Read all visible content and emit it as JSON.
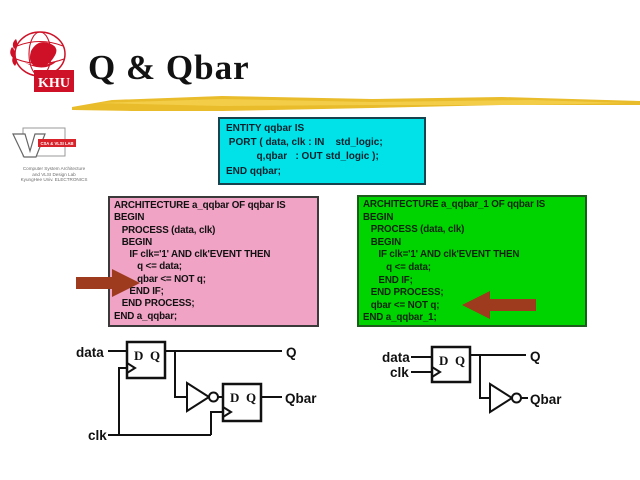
{
  "colors": {
    "entity_bg": "#00E2E8",
    "arch_left_bg": "#F1A3C5",
    "arch_right_bg": "#00D400",
    "arrow": "#9E3A1E",
    "underline_gold": "#E9BC2B",
    "underline_gold_light": "#F4D04E",
    "logo_red": "#CE1126"
  },
  "header": {
    "title": "Q & Qbar",
    "khu_logo_text": "KHU"
  },
  "lab_logo": {
    "banner_text": "CSA & VLSI LAB",
    "caption_lines": [
      "Computer System Architecture",
      "and VLSI Design Lab",
      "KyungHee Univ. ELECTRONICS"
    ]
  },
  "entity_box": {
    "lines": [
      "ENTITY qqbar IS",
      " PORT ( data, clk : IN    std_logic;",
      "           q,qbar   : OUT std_logic );",
      "END qqbar;"
    ]
  },
  "arch_left_box": {
    "lines": [
      "ARCHITECTURE a_qqbar OF qqbar IS",
      "BEGIN",
      "   PROCESS (data, clk)",
      "   BEGIN",
      "      IF clk='1' AND clk'EVENT THEN",
      "         q <= data;",
      "         qbar <= NOT q;",
      "      END IF;",
      "   END PROCESS;",
      "END a_qqbar;"
    ]
  },
  "arch_right_box": {
    "lines": [
      "ARCHITECTURE a_qqbar_1 OF qqbar IS",
      "BEGIN",
      "   PROCESS (data, clk)",
      "   BEGIN",
      "      IF clk='1' AND clk'EVENT THEN",
      "         q <= data;",
      "      END IF;",
      "   END PROCESS;",
      "   qbar <= NOT q;",
      "END a_qqbar_1;"
    ]
  },
  "circuit_left": {
    "labels": {
      "data": "data",
      "clk": "clk",
      "q": "Q",
      "qbar": "Qbar",
      "ff1_d": "D",
      "ff1_q": "Q",
      "ff2_d": "D",
      "ff2_q": "Q"
    }
  },
  "circuit_right": {
    "labels": {
      "data": "data",
      "clk": "clk",
      "q": "Q",
      "qbar": "Qbar",
      "ff_d": "D",
      "ff_q": "Q"
    }
  }
}
